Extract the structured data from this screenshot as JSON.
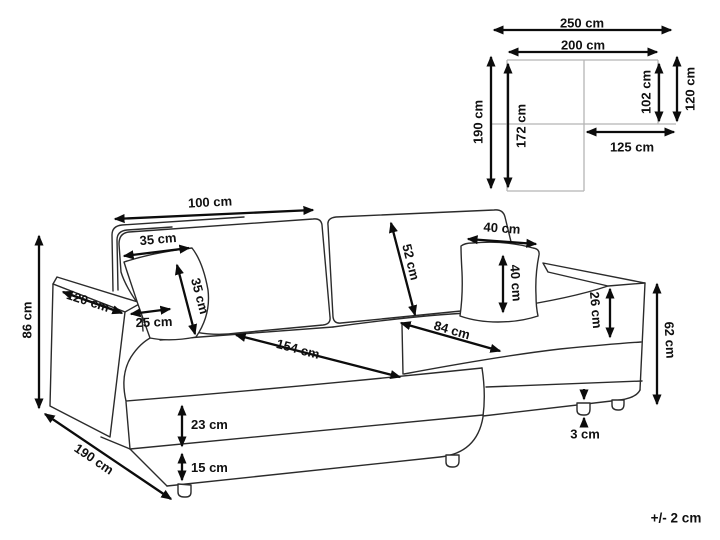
{
  "figure": {
    "title": "corner-sofa-dimension-diagram",
    "tolerance_note": "+/- 2 cm",
    "units": "cm",
    "colors": {
      "line": "#2b2b2b",
      "arrow": "#0c0c0c",
      "schematic_line": "#b5b5b5",
      "background": "#ffffff"
    }
  },
  "top_view": {
    "total_width": "250 cm",
    "back_width": "200 cm",
    "total_depth": "190 cm",
    "inner_depth": "172 cm",
    "right_inner_depth": "102 cm",
    "right_depth": "120 cm",
    "right_width": "125 cm"
  },
  "sofa_view": {
    "backrest_width": "100 cm",
    "small_pillow_width": "35 cm",
    "small_pillow_height": "35 cm",
    "backrest_height": "52 cm",
    "large_pillow_width": "40 cm",
    "large_pillow_height": "40 cm",
    "armrest_length": "120 cm",
    "armrest_width": "25 cm",
    "overall_height": "86 cm",
    "chaise_seat_length": "154 cm",
    "seat_depth": "84 cm",
    "armrest_above_seat": "26 cm",
    "side_height": "62 cm",
    "chaise_length": "190 cm",
    "seat_cushion_height": "23 cm",
    "base_height": "15 cm",
    "leg_height": "3 cm"
  }
}
